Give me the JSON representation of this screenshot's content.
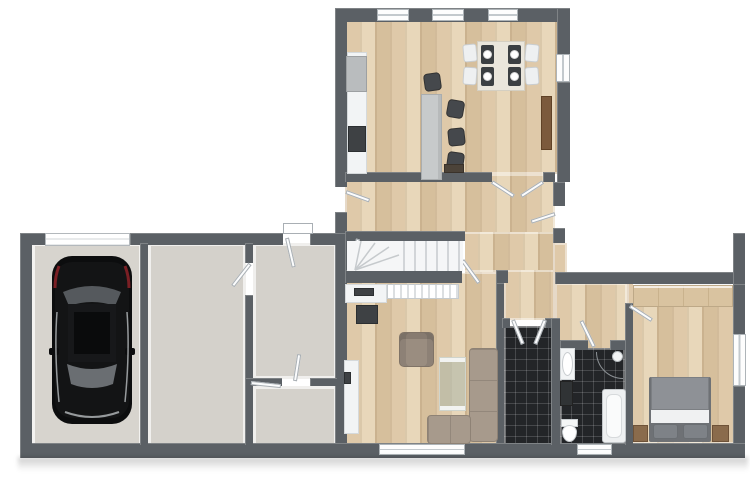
{
  "scene": {
    "description": "3D top-down floor plan render of a single-storey house with attached garage wing",
    "view": "top-down isometric-style render",
    "visible_text": "none"
  },
  "colors": {
    "paper": "#ffffff",
    "wall": "#5b6065",
    "wood_a": "#dfc9a9",
    "wood_b": "#e8d7ba",
    "wood_c": "#d6bf9c",
    "subfloor": "#d4d1cb",
    "garage_floor": "#d7d4ce",
    "tile_dark": "#232528",
    "fixture_white": "#f2f4f5",
    "sofa": "#a79a8c",
    "armchair": "#9a8d80",
    "island": "#c7cacb",
    "stool": "#45484c",
    "mat": "#3b3f42",
    "dining_table": "#eae6dc",
    "sideboard_brown": "#7b5a3c",
    "wardrobe_wood": "#d9c3a0",
    "nightstand_brown": "#8a6b4c",
    "bed_duvet": "#8e9196",
    "bed_pillow": "#7e8287",
    "bed_sheet": "#f0f1f2",
    "car_body": "#0c0d0e",
    "car_glass": "#63676b"
  },
  "rooms": [
    {
      "id": "kitchen-dining",
      "floor": "wood",
      "features": [
        "kitchen counter",
        "fridge",
        "cooktop",
        "island with 4 bar stools",
        "dining table for 4",
        "brown sideboard",
        "3 top windows",
        "1 side window"
      ]
    },
    {
      "id": "hallway",
      "floor": "wood",
      "features": [
        "winder staircase",
        "exterior door west",
        "exterior door east",
        "double door to kitchen"
      ]
    },
    {
      "id": "living-room",
      "floor": "wood",
      "features": [
        "corner sofa",
        "armchair",
        "glass coffee table",
        "tv cabinet",
        "radiator",
        "sideboard",
        "bottom window"
      ]
    },
    {
      "id": "entry-hall",
      "floor": "black-tile",
      "features": [
        "double doors"
      ]
    },
    {
      "id": "bathroom",
      "floor": "black-tile",
      "features": [
        "washbasin with vanity",
        "toilet",
        "bathtub",
        "corner shower",
        "bottom window"
      ]
    },
    {
      "id": "bedroom",
      "floor": "wood",
      "features": [
        "double bed",
        "2 nightstands",
        "wardrobe row",
        "side window"
      ]
    },
    {
      "id": "garage",
      "floor": "concrete",
      "features": [
        "black car",
        "garage door"
      ]
    },
    {
      "id": "storage-room-large",
      "floor": "concrete",
      "features": []
    },
    {
      "id": "storage-room-upper",
      "floor": "concrete",
      "features": [
        "exterior door with porch step"
      ]
    },
    {
      "id": "storage-room-lower",
      "floor": "concrete",
      "features": []
    }
  ],
  "counts": {
    "windows": 7,
    "exterior_doors": 3,
    "garage_doors": 1,
    "interior_door_leaves": 12,
    "bar_stools": 4,
    "dining_chairs": 4
  }
}
